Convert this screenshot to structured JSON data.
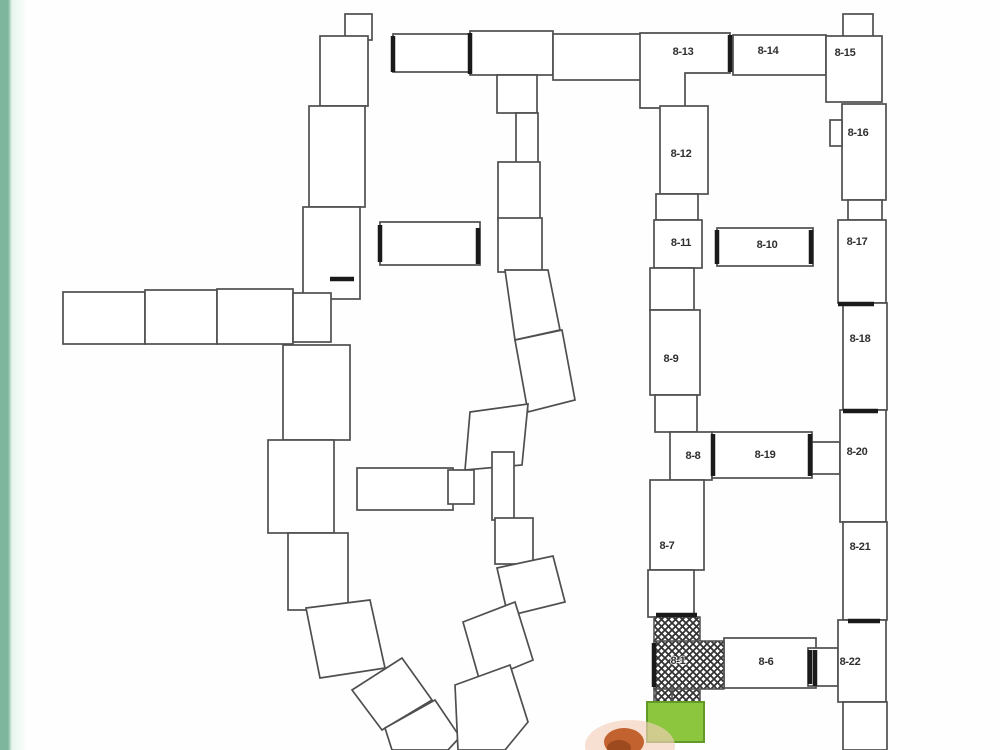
{
  "page": {
    "kind": "scanned site plan of building complex",
    "background": "#fefefe"
  },
  "colors": {
    "background": "#fefefe",
    "line": "#4f4f4f",
    "bold": "#1a1a1a",
    "label": "#2f2f2f",
    "stripe": "#7db69d",
    "stripe_fade": "#e7f6ee",
    "highlight_green": "#8cc63e",
    "highlight_green_edge": "#639a27",
    "marker_orange": "#c2622e",
    "marker_orange_dark": "#9e4a1f",
    "marker_halo": "#f3cfba"
  },
  "map": {
    "labels": [
      {
        "id": "8-1",
        "x": 678,
        "y": 661
      },
      {
        "id": "8-6",
        "x": 766,
        "y": 662
      },
      {
        "id": "8-7",
        "x": 667,
        "y": 546
      },
      {
        "id": "8-8",
        "x": 693,
        "y": 456
      },
      {
        "id": "8-9",
        "x": 671,
        "y": 359
      },
      {
        "id": "8-10",
        "x": 767,
        "y": 245
      },
      {
        "id": "8-11",
        "x": 681,
        "y": 243
      },
      {
        "id": "8-12",
        "x": 681,
        "y": 154
      },
      {
        "id": "8-13",
        "x": 683,
        "y": 52
      },
      {
        "id": "8-14",
        "x": 768,
        "y": 51
      },
      {
        "id": "8-15",
        "x": 845,
        "y": 53
      },
      {
        "id": "8-16",
        "x": 858,
        "y": 133
      },
      {
        "id": "8-17",
        "x": 857,
        "y": 242
      },
      {
        "id": "8-18",
        "x": 860,
        "y": 339
      },
      {
        "id": "8-19",
        "x": 765,
        "y": 455
      },
      {
        "id": "8-20",
        "x": 857,
        "y": 452
      },
      {
        "id": "8-21",
        "x": 860,
        "y": 547
      },
      {
        "id": "8-22",
        "x": 850,
        "y": 662
      }
    ],
    "highlights": {
      "hatched_building_id": "8-1",
      "green_area": {
        "x": 647,
        "y": 702,
        "w": 57,
        "h": 40
      },
      "orange_marker": {
        "cx": 624,
        "cy": 740
      }
    }
  }
}
